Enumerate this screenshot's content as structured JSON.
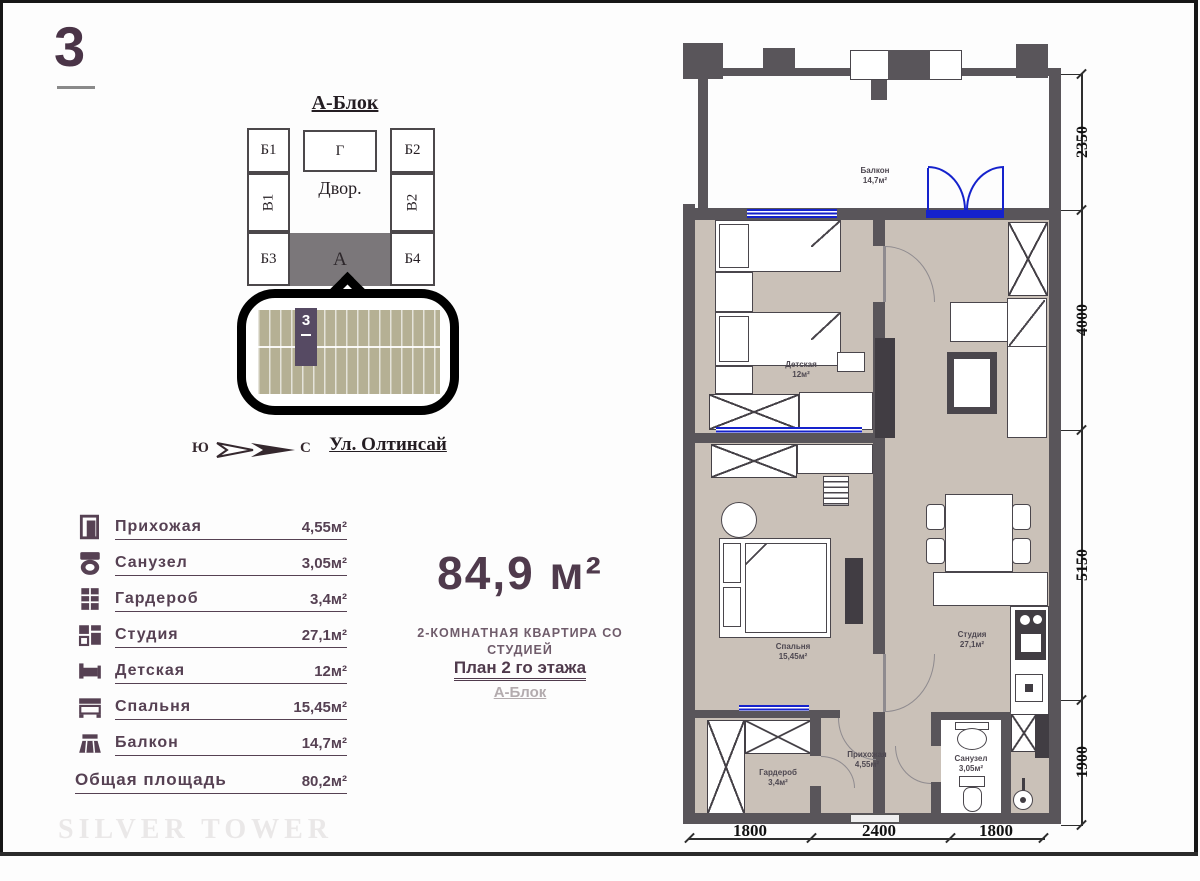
{
  "page": {
    "sheet_number": "3",
    "watermark": "SILVER TOWER"
  },
  "block_diagram": {
    "title": "А-Блок",
    "cells": {
      "b1": "Б1",
      "g": "Г",
      "b2": "Б2",
      "v1": "В1",
      "courtyard": "Двор.",
      "v2": "В2",
      "b3": "Б3",
      "a": "А",
      "b4": "Б4"
    },
    "position_number": "3"
  },
  "compass": {
    "west": "Ю",
    "east": "С",
    "street": "Ул. Олтинсай"
  },
  "summary": {
    "total_area": "84,9 м²",
    "subtitle_line1": "2-КОМНАТНАЯ КВАРТИРА СО",
    "subtitle_line2": "СТУДИЕЙ",
    "plan_line": "План 2 го этажа",
    "block_line": "А-Блок"
  },
  "room_list": {
    "rows": [
      {
        "icon": "door-icon",
        "label": "Прихожая",
        "value": "4,55м²"
      },
      {
        "icon": "toilet-icon",
        "label": "Санузел",
        "value": "3,05м²"
      },
      {
        "icon": "wardrobe-icon",
        "label": "Гардероб",
        "value": "3,4м²"
      },
      {
        "icon": "studio-icon",
        "label": "Студия",
        "value": "27,1м²"
      },
      {
        "icon": "kids-bed-icon",
        "label": "Детская",
        "value": "12м²"
      },
      {
        "icon": "bed-icon",
        "label": "Спальня",
        "value": "15,45м²"
      },
      {
        "icon": "balcony-icon",
        "label": "Балкон",
        "value": "14,7м²"
      }
    ],
    "total_label": "Общая площадь",
    "total_value": "80,2м²"
  },
  "floor_plan": {
    "rooms": {
      "balcony": {
        "name": "Балкон",
        "area": "14,7м²"
      },
      "kids_room": {
        "name": "Детская",
        "area": "12м²"
      },
      "bedroom": {
        "name": "Спальня",
        "area": "15,45м²"
      },
      "studio": {
        "name": "Студия",
        "area": "27,1м²"
      },
      "wardrobe": {
        "name": "Гардероб",
        "area": "3,4м²"
      },
      "hallway": {
        "name": "Прихожая",
        "area": "4,55м²"
      },
      "bathroom": {
        "name": "Санузел",
        "area": "3,05м²"
      }
    },
    "dims_right": [
      "2350",
      "4000",
      "5150",
      "1900"
    ],
    "dims_bottom": [
      "1800",
      "2400",
      "1800"
    ]
  },
  "colors": {
    "accent_text": "#4f3a4c",
    "wall": "#59555a",
    "floor_beige": "#cac1b8",
    "window_blue": "#1522cc",
    "locator_khaki": "#b5b094",
    "locator_band": "#564a63"
  }
}
